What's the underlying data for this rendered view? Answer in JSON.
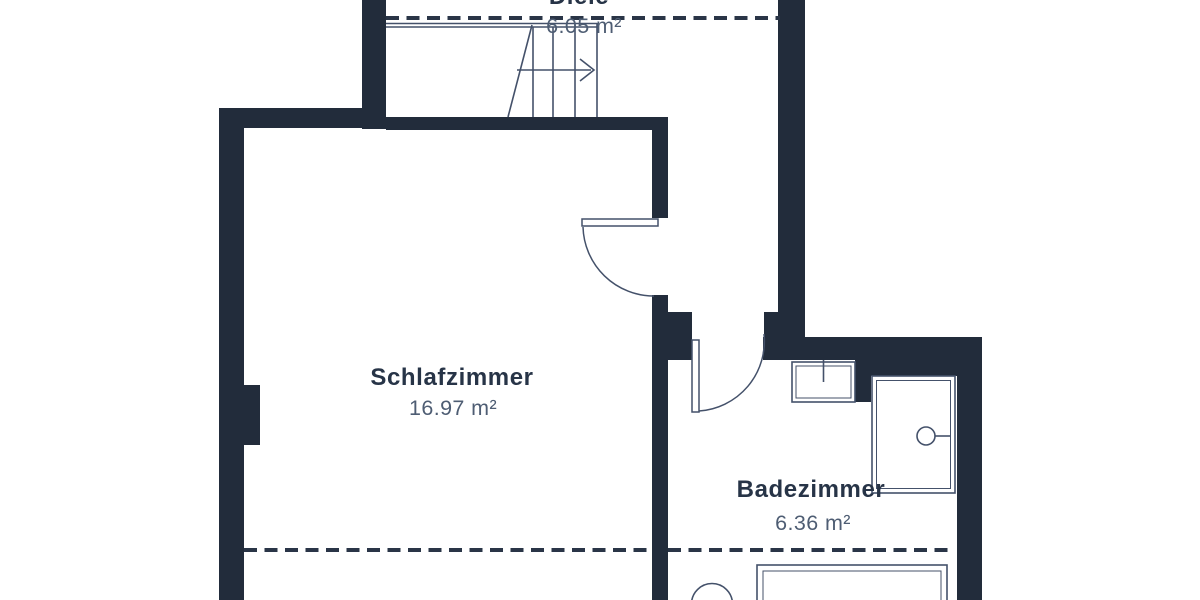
{
  "document": {
    "kind": "floor-plan",
    "language": "de"
  },
  "rooms": [
    {
      "id": "diele",
      "name": "Diele",
      "area": "6.05 m²"
    },
    {
      "id": "schlafzimmer",
      "name": "Schlafzimmer",
      "area": "16.97 m²"
    },
    {
      "id": "badezimmer",
      "name": "Badezimmer",
      "area": "6.36 m²"
    }
  ],
  "fixtures": [
    {
      "id": "staircase",
      "name": "staircase with up-direction arrow",
      "room": "diele"
    },
    {
      "id": "door-schlafzimmer",
      "name": "door swinging into bedroom",
      "room": "schlafzimmer"
    },
    {
      "id": "door-badezimmer",
      "name": "door swinging into bathroom",
      "room": "badezimmer"
    },
    {
      "id": "washbasin",
      "name": "washbasin with tap mark",
      "room": "badezimmer"
    },
    {
      "id": "bathtub",
      "name": "bathtub with drain circle",
      "room": "badezimmer"
    },
    {
      "id": "toilet",
      "name": "toilet (partially cut off)",
      "room": "badezimmer"
    },
    {
      "id": "shower-tray",
      "name": "shower tray (partially cut off)",
      "room": "badezimmer"
    }
  ],
  "colors": {
    "wall": "#222c3b",
    "line": "#44516a",
    "dash": "#2a3547",
    "room_name_text": "#273447",
    "room_area_text": "#4e5d73",
    "background": "#ffffff"
  }
}
